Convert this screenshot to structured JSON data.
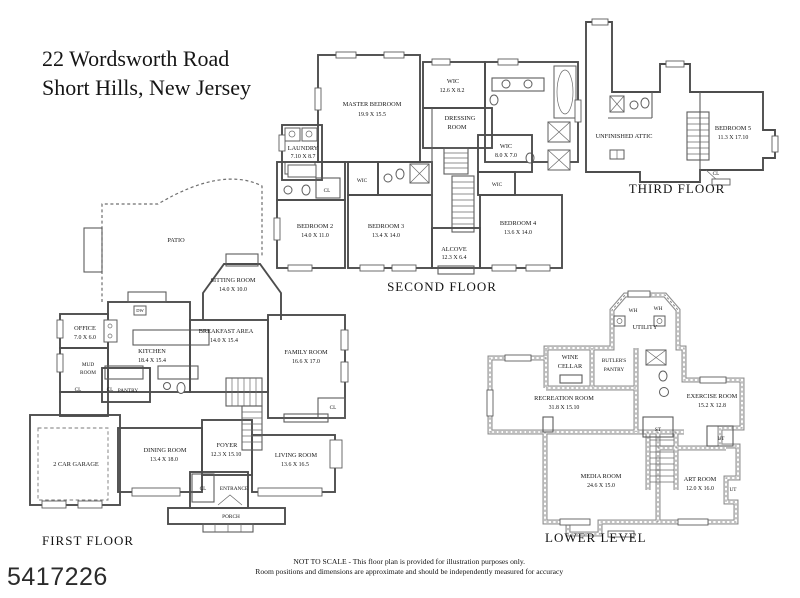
{
  "title": {
    "line1": "22 Wordsworth Road",
    "line2": "Short Hills, New Jersey"
  },
  "photo_id": "5417226",
  "disclaimer": {
    "line1": "NOT TO SCALE - This floor plan is provided for illustration purposes only.",
    "line2": "Room positions and dimensions are approximate and should be independently measured for accuracy"
  },
  "colors": {
    "wall": "#4d4d4d",
    "lower_wall": "#8f8f8f",
    "text": "#141414",
    "background": "#ffffff"
  },
  "floors": {
    "first": {
      "label": "FIRST FLOOR",
      "rooms": {
        "patio": {
          "name": "PATIO"
        },
        "sitting_room": {
          "name": "SITTING ROOM",
          "dims": "14.0 X 10.0"
        },
        "office": {
          "name": "OFFICE",
          "dims": "7.0 X 6.0"
        },
        "kitchen": {
          "name": "KITCHEN",
          "dims": "18.4 X 15.4"
        },
        "breakfast_area": {
          "name": "BREAKFAST AREA",
          "dims": "14.0 X 15.4"
        },
        "family_room": {
          "name": "FAMILY ROOM",
          "dims": "16.6 X 17.0"
        },
        "mud_room": {
          "name": "MUD",
          "name2": "ROOM"
        },
        "mud_cl": {
          "name": "CL"
        },
        "pantry_cl": {
          "name": "CL"
        },
        "pantry": {
          "name": "PANTRY"
        },
        "dishwasher": {
          "name": "DW"
        },
        "dining_room": {
          "name": "DINING ROOM",
          "dims": "13.4 X 18.0"
        },
        "foyer": {
          "name": "FOYER",
          "dims": "12.3 X 15.10"
        },
        "living_room": {
          "name": "LIVING ROOM",
          "dims": "13.6 X 16.5"
        },
        "family_cl": {
          "name": "CL"
        },
        "entrance_cl": {
          "name": "CL"
        },
        "entrance": {
          "name": "ENTRANCE"
        },
        "porch": {
          "name": "PORCH"
        },
        "garage": {
          "name": "2 CAR GARAGE"
        }
      }
    },
    "second": {
      "label": "SECOND FLOOR",
      "rooms": {
        "master_bedroom": {
          "name": "MASTER BEDROOM",
          "dims": "19.9 X 15.5"
        },
        "laundry": {
          "name": "LAUNDRY",
          "dims": "7.10 X 8.7"
        },
        "wic_master": {
          "name": "WIC",
          "dims": "12.6 X 8.2"
        },
        "dressing_room": {
          "name": "DRESSING",
          "name2": "ROOM"
        },
        "wic_hall": {
          "name": "WIC",
          "dims": "8.0 X 7.0"
        },
        "wic_small": {
          "name": "WIC"
        },
        "wic_bedroom3": {
          "name": "WIC"
        },
        "bedroom2_cl": {
          "name": "CL"
        },
        "bedroom2": {
          "name": "BEDROOM 2",
          "dims": "14.0 X 11.0"
        },
        "bedroom3": {
          "name": "BEDROOM 3",
          "dims": "13.4 X 14.0"
        },
        "bedroom4": {
          "name": "BEDROOM 4",
          "dims": "13.6 X 14.0"
        },
        "alcove": {
          "name": "ALCOVE",
          "dims": "12.3 X 6.4"
        }
      }
    },
    "third": {
      "label": "THIRD FLOOR",
      "rooms": {
        "unfinished_attic": {
          "name": "UNFINISHED ATTIC"
        },
        "bedroom5": {
          "name": "BEDROOM 5",
          "dims": "11.3 X 17.10"
        },
        "cl": {
          "name": "CL"
        }
      }
    },
    "lower": {
      "label": "LOWER LEVEL",
      "rooms": {
        "wh1": {
          "name": "WH"
        },
        "wh2": {
          "name": "WH"
        },
        "utility": {
          "name": "UTILITY"
        },
        "wine_cellar": {
          "name": "WINE",
          "name2": "CELLAR"
        },
        "butlers_pantry": {
          "name": "BUTLER'S",
          "name2": "PANTRY"
        },
        "recreation_room": {
          "name": "RECREATION ROOM",
          "dims": "31.8 X 15.10"
        },
        "exercise_room": {
          "name": "EXERCISE ROOM",
          "dims": "15.2 X 12.8"
        },
        "st": {
          "name": "ST"
        },
        "ut1": {
          "name": "UT"
        },
        "media_room": {
          "name": "MEDIA ROOM",
          "dims": "24.6 X 15.0"
        },
        "art_room": {
          "name": "ART ROOM",
          "dims": "12.0 X 16.0"
        },
        "ut2": {
          "name": "UT"
        }
      }
    }
  }
}
